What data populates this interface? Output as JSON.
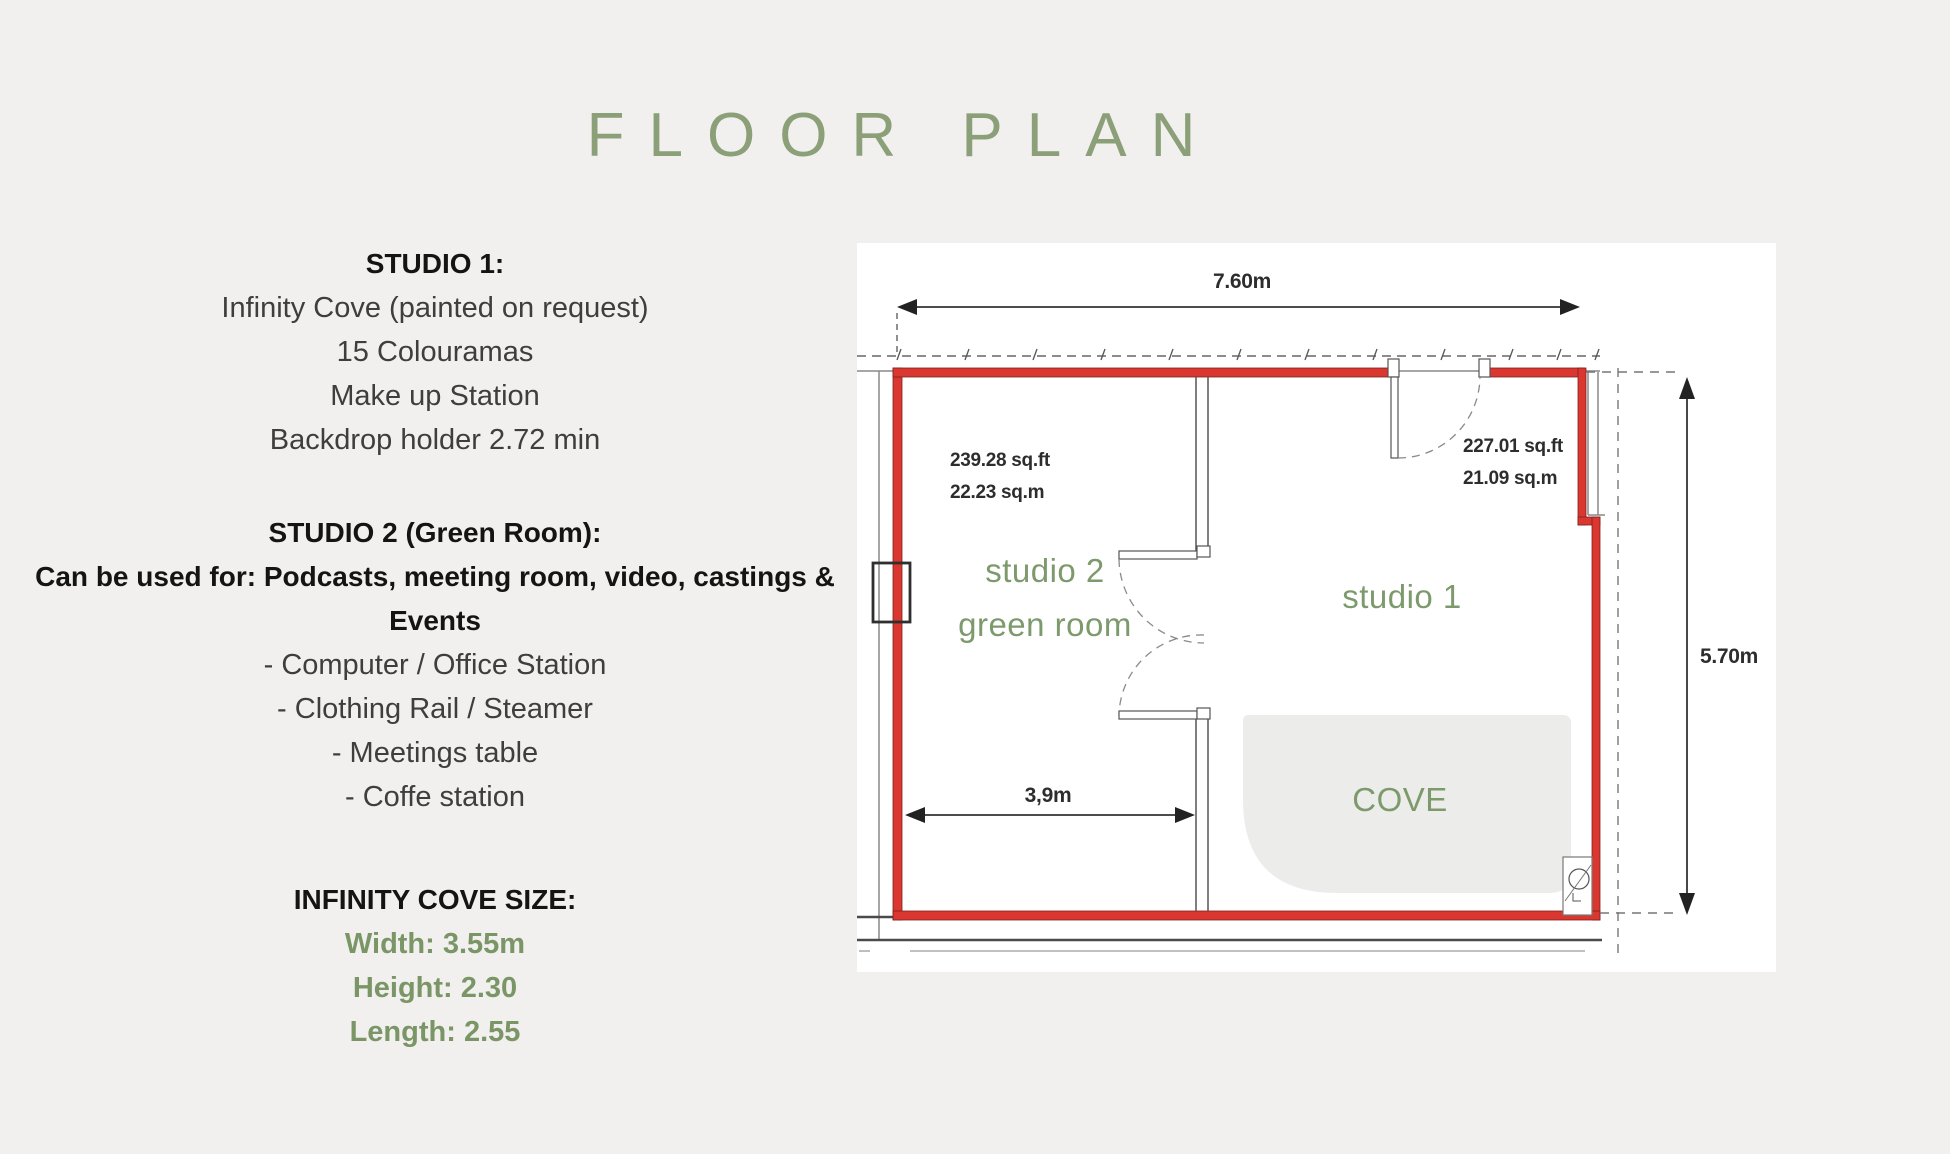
{
  "page": {
    "title": "FLOOR PLAN",
    "background": "#f2f0ee"
  },
  "colors": {
    "title_green": "#8b9f78",
    "label_green": "#7d9a6c",
    "metric_green": "#7a9566",
    "wall_red": "#d9372f",
    "plan_ink": "#2d2d2d"
  },
  "info": {
    "studio1": {
      "heading": "STUDIO 1:",
      "lines": [
        "Infinity Cove (painted on request)",
        "15 Colouramas",
        "Make up Station",
        "Backdrop holder 2.72 min"
      ]
    },
    "studio2": {
      "heading": "STUDIO 2 (Green Room):",
      "usage_line1": "Can be used for: Podcasts, meeting room, video, castings &",
      "usage_line2": "Events",
      "items": [
        "- Computer / Office Station",
        "- Clothing Rail / Steamer",
        "- Meetings table",
        "- Coffe station"
      ]
    },
    "cove": {
      "heading": "INFINITY COVE SIZE:",
      "metrics": [
        "Width: 3.55m",
        "Height: 2.30",
        "Length: 2.55"
      ]
    }
  },
  "plan": {
    "dim_top": "7.60m",
    "dim_right": "5.70m",
    "dim_inner": "3,9m",
    "studio2_area_sqft": "239.28 sq.ft",
    "studio2_area_sqm": "22.23 sq.m",
    "studio1_area_sqft": "227.01 sq.ft",
    "studio1_area_sqm": "21.09 sq.m",
    "studio2_name_line1": "studio 2",
    "studio2_name_line2": "green room",
    "studio1_name": "studio 1",
    "cove_label": "COVE"
  }
}
